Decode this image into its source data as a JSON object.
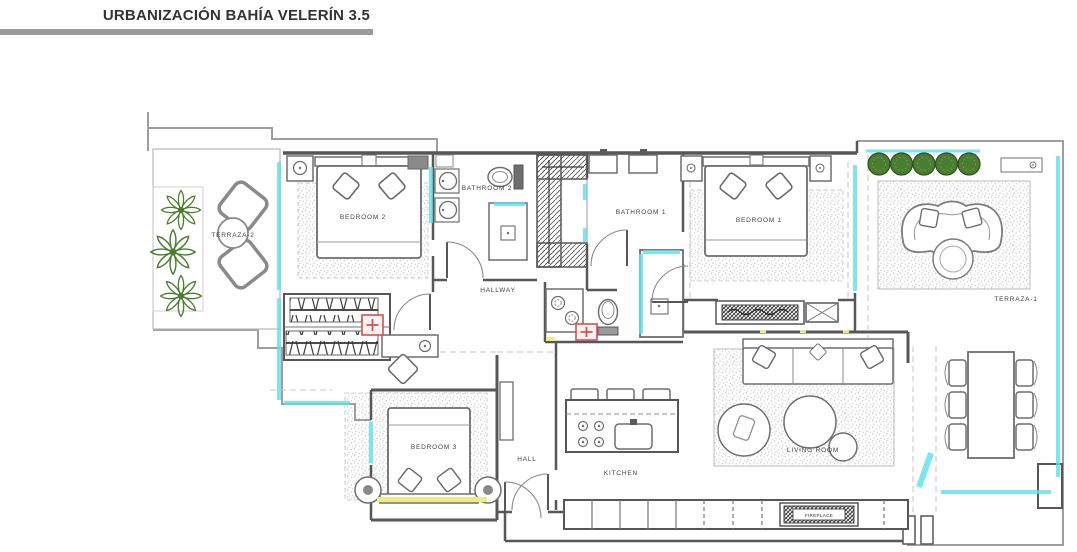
{
  "header": {
    "title": "URBANIZACIÓN BAHÍA VELERÍN 3.5"
  },
  "plan": {
    "rooms": {
      "terraza2": "TERRAZA-2",
      "bedroom2": "BEDROOM 2",
      "bathroom2": "BATHROOM 2",
      "bathroom1": "BATHROOM 1",
      "bedroom1": "BEDROOM 1",
      "terraza1": "TERRAZA-1",
      "hallway": "HALLWAY",
      "hall": "HALL",
      "bedroom3": "BEDROOM 3",
      "kitchen": "KITCHEN",
      "living_room": "LIVING ROOM",
      "fireplace": "FIREPLACE"
    },
    "colors": {
      "wall": "#575757",
      "light_line": "#9e9e9e",
      "glass": "#5fe0ea",
      "plant_green": "#4c7c31",
      "accent_red": "#d05252",
      "accent_yellow": "#eeeb85",
      "rug_dot": "#a5a5a5",
      "label_text": "#3f3f3f",
      "title_bar": "#9b9b9b"
    }
  }
}
